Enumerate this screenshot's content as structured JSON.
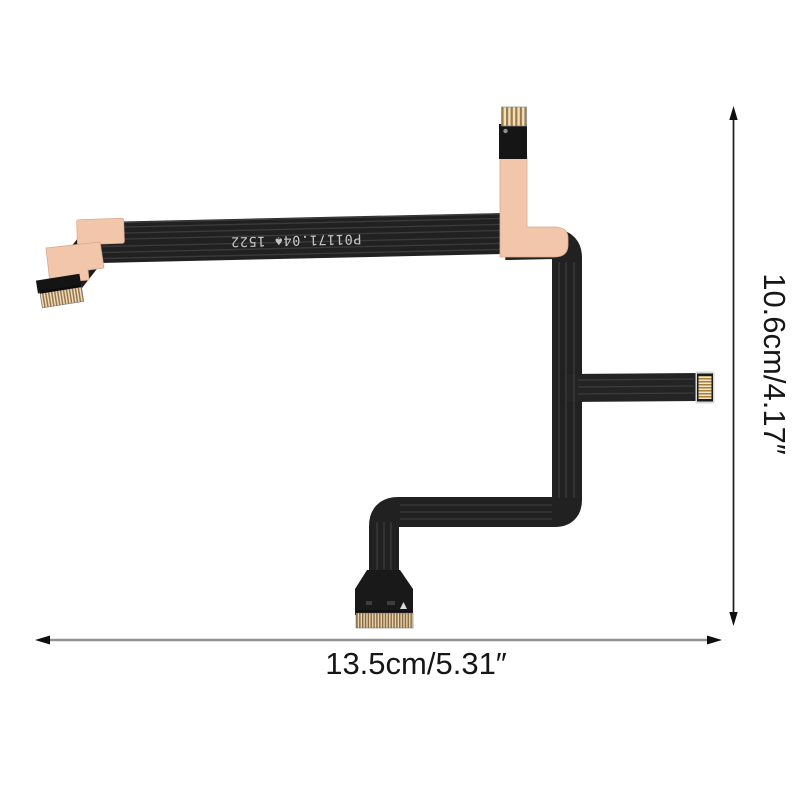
{
  "photo": {
    "subject": "flexible flat ribbon cable with four gold-pin connectors and peach stiffener pads",
    "background_color": "#ffffff"
  },
  "cable": {
    "marking": "P01171.04♠ 1522",
    "marking_color": "#c6c6c6",
    "ribbon_color": "#212121",
    "stiffener_color": "#f2c6aa",
    "pin_gold_color": "#a07c42",
    "pin_cream_color": "#eee0c2",
    "connector_count": "4"
  },
  "annotations": {
    "width_label": "13.5cm/5.31″",
    "height_label": "10.6cm/4.17″",
    "label_color": "#161616",
    "width_line_color": "#929292",
    "height_line_color": "#1c1c1c",
    "arrow_color": "#0f0f0f"
  }
}
